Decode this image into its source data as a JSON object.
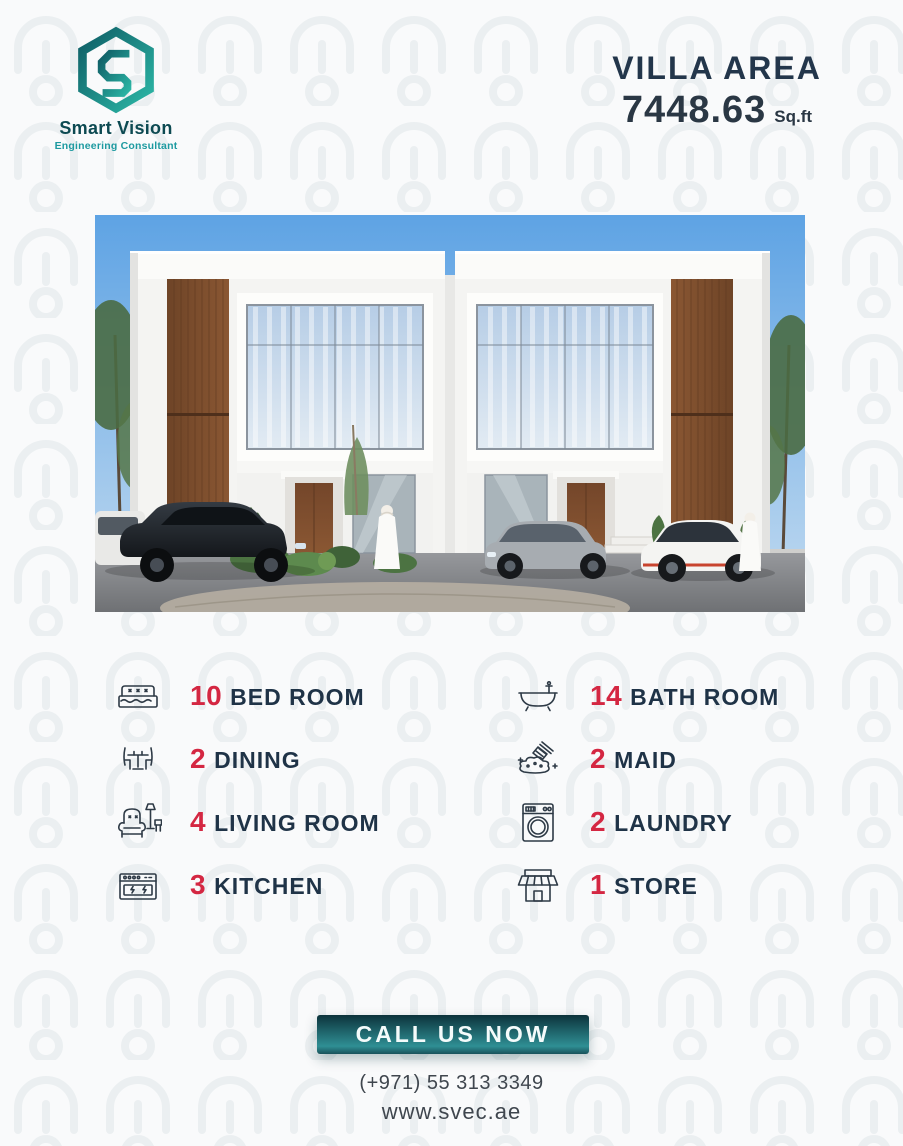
{
  "brand": {
    "name": "Smart Vision",
    "tagline": "Engineering Consultant"
  },
  "area": {
    "title": "VILLA AREA",
    "value": "7448.63",
    "unit": "Sq.ft"
  },
  "features": {
    "left": [
      {
        "icon": "bed-icon",
        "count": "10",
        "label": "BED ROOM"
      },
      {
        "icon": "dining-icon",
        "count": "2",
        "label": "DINING"
      },
      {
        "icon": "living-room-icon",
        "count": "4",
        "label": "LIVING ROOM"
      },
      {
        "icon": "kitchen-icon",
        "count": "3",
        "label": "KITCHEN"
      }
    ],
    "right": [
      {
        "icon": "bathtub-icon",
        "count": "14",
        "label": "BATH ROOM"
      },
      {
        "icon": "maid-icon",
        "count": "2",
        "label": "MAID"
      },
      {
        "icon": "laundry-icon",
        "count": "2",
        "label": "LAUNDRY"
      },
      {
        "icon": "store-icon",
        "count": "1",
        "label": "STORE"
      }
    ]
  },
  "cta": {
    "label": "CALL US NOW"
  },
  "contact": {
    "phone": "(+971) 55 313 3349",
    "website": "www.svec.ae"
  },
  "colors": {
    "accent_red": "#d42742",
    "text_dark": "#1f3347",
    "teal_dark": "#0f5e66",
    "teal_light": "#2cb7a6",
    "background": "#f9fafb"
  },
  "villa_image": {
    "description": "3D render of symmetric modern white duplex villa with wood panels, glass facades, cars and two figures in front"
  }
}
